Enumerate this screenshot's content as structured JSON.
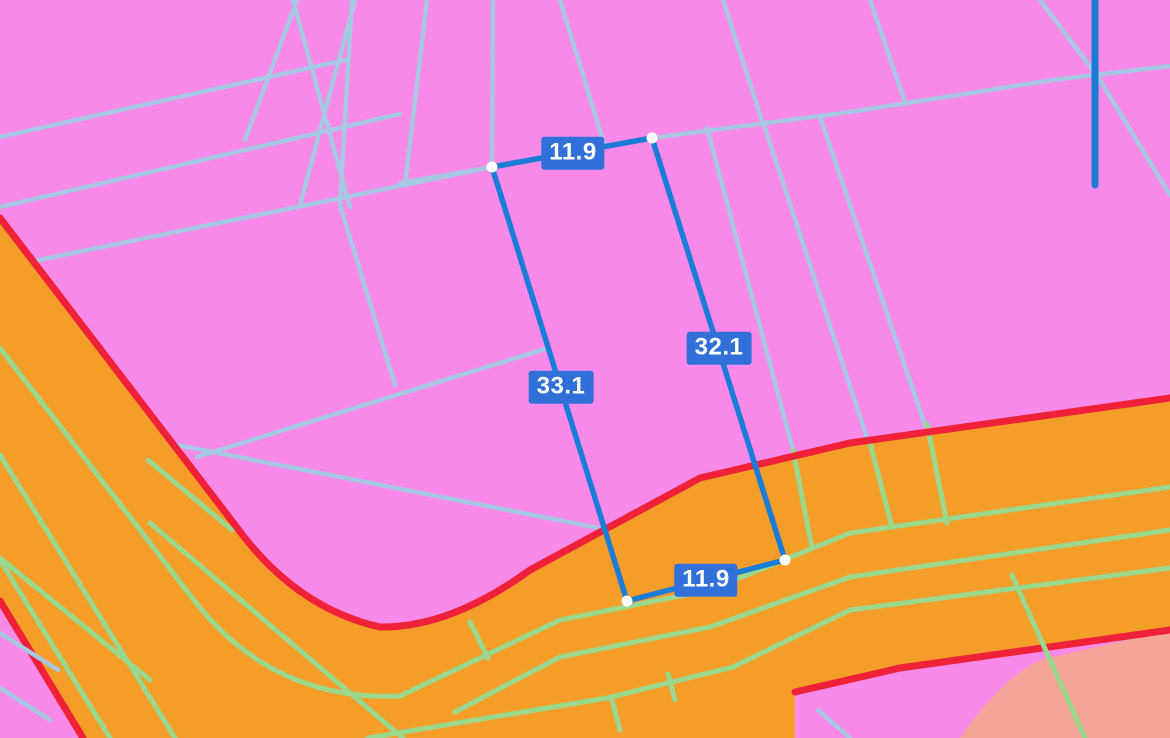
{
  "app": {
    "type": "map-measurement-view",
    "description": "Cadastral zoning map with distance measurement overlay"
  },
  "measurement": {
    "unit_suffix": "",
    "segments": [
      {
        "side": "top",
        "value": "11.9"
      },
      {
        "side": "right",
        "value": "32.1"
      },
      {
        "side": "left",
        "value": "33.1"
      },
      {
        "side": "bottom",
        "value": "11.9"
      }
    ],
    "vertex_count": 4
  },
  "legend_colors": {
    "zone_pink": "#fa8ae9",
    "zone_orange": "#f59d29",
    "zone_salmon": "#f4a598",
    "zone_edge_red": "#ef2138",
    "parcel_line_blue": "#a6c8e2",
    "parcel_line_green": "#9ad88d",
    "measure_blue": "#1b7cd8",
    "label_chip_blue": "#3070d8",
    "vertex_dot_white": "#ffffff"
  }
}
